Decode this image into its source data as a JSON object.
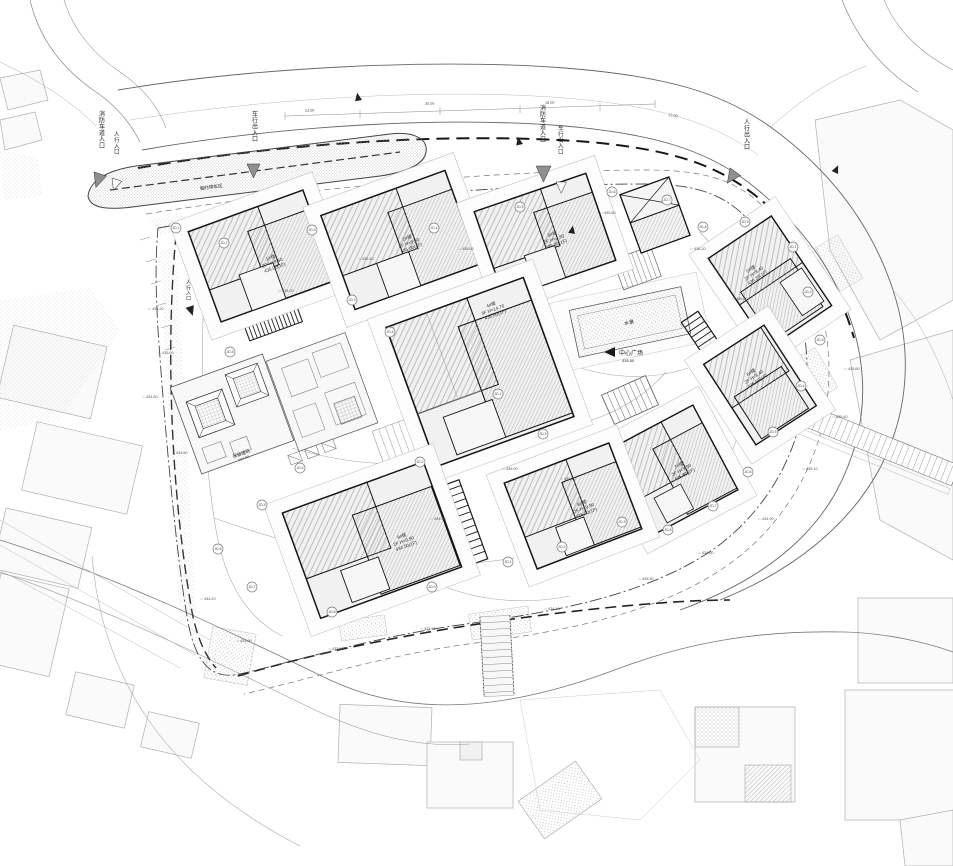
{
  "palette": {
    "paper": "#ffffff",
    "building_line": "#161616",
    "road_line": "#666666",
    "light_line": "#b0b0b0",
    "arrow_fill": "#8f8f8f",
    "boundary": "#333333"
  },
  "texts": {
    "plaza": "中心广场",
    "plaza_elev": "435.50",
    "pool": "水景",
    "island": "临时停车区",
    "preserved": "保留建筑",
    "preserved_elev": "434.80"
  },
  "buildings": [
    {
      "name": "1#楼",
      "l2": "2F H=9.50",
      "l3": "435.00(1F)"
    },
    {
      "name": "2#楼",
      "l2": "2F H=9.50",
      "l3": "435.00(1F)"
    },
    {
      "name": "3#楼",
      "l2": "2F H=9.50",
      "l3": "435.30(1F)"
    },
    {
      "name": "4#楼",
      "l2": "3F H=14.70",
      "l3": "435.00(1F)"
    },
    {
      "name": "5#楼",
      "l2": "2F H=8.40",
      "l3": "436.20(1F)"
    },
    {
      "name": "6#楼",
      "l2": "2F H=8.40",
      "l3": "436.50(1F)"
    },
    {
      "name": "7#楼",
      "l2": "2F H=9.90",
      "l3": "435.80(1F)"
    },
    {
      "name": "8#楼",
      "l2": "2F H=9.90",
      "l3": "435.00(1F)"
    },
    {
      "name": "9#楼",
      "l2": "2F H=9.90",
      "l3": "434.50(1F)"
    }
  ],
  "vertical_labels": [
    {
      "x": 99,
      "y": 116,
      "s": 6.0,
      "t": "消防车道入口"
    },
    {
      "x": 114,
      "y": 136,
      "s": 5.6,
      "t": "人行入口"
    },
    {
      "x": 252,
      "y": 116,
      "s": 6.0,
      "t": "车行出入口"
    },
    {
      "x": 540,
      "y": 110,
      "s": 6.0,
      "t": "消防车道入口"
    },
    {
      "x": 558,
      "y": 130,
      "s": 5.6,
      "t": "车行出入口"
    },
    {
      "x": 744,
      "y": 124,
      "s": 6.0,
      "t": "人行出入口"
    },
    {
      "x": 186,
      "y": 284,
      "s": 5.0,
      "t": "人行入口"
    }
  ],
  "annotations": [
    {
      "x": 176,
      "y": 228,
      "c": "JD-1"
    },
    {
      "x": 224,
      "y": 243,
      "c": "JD-2"
    },
    {
      "x": 312,
      "y": 230,
      "c": "JD-3"
    },
    {
      "x": 434,
      "y": 228,
      "c": "JD-4"
    },
    {
      "x": 520,
      "y": 207,
      "c": "JD-5"
    },
    {
      "x": 612,
      "y": 192,
      "c": "JD-6"
    },
    {
      "x": 667,
      "y": 200,
      "c": "JD-7"
    },
    {
      "x": 703,
      "y": 227,
      "c": "JD-8"
    },
    {
      "x": 745,
      "y": 222,
      "c": "JD-9"
    },
    {
      "x": 793,
      "y": 247,
      "c": "JD-1"
    },
    {
      "x": 808,
      "y": 292,
      "c": "JD-2"
    },
    {
      "x": 820,
      "y": 340,
      "c": "JD-3"
    },
    {
      "x": 801,
      "y": 386,
      "c": "JD-4"
    },
    {
      "x": 773,
      "y": 432,
      "c": "JD-5"
    },
    {
      "x": 748,
      "y": 472,
      "c": "JD-6"
    },
    {
      "x": 713,
      "y": 506,
      "c": "JD-7"
    },
    {
      "x": 668,
      "y": 530,
      "c": "JD-8"
    },
    {
      "x": 543,
      "y": 434,
      "c": "JD-9"
    },
    {
      "x": 498,
      "y": 394,
      "c": "JD-1"
    },
    {
      "x": 420,
      "y": 462,
      "c": "JD-2"
    },
    {
      "x": 352,
      "y": 300,
      "c": "JD-3"
    },
    {
      "x": 300,
      "y": 468,
      "c": "JD-4"
    },
    {
      "x": 262,
      "y": 505,
      "c": "JD-5"
    },
    {
      "x": 218,
      "y": 549,
      "c": "JD-6"
    },
    {
      "x": 252,
      "y": 587,
      "c": "JD-7"
    },
    {
      "x": 332,
      "y": 612,
      "c": "JD-8"
    },
    {
      "x": 432,
      "y": 587,
      "c": "JD-9"
    },
    {
      "x": 508,
      "y": 562,
      "c": "JD-1"
    },
    {
      "x": 562,
      "y": 547,
      "c": "JD-2"
    },
    {
      "x": 622,
      "y": 522,
      "c": "JD-3"
    },
    {
      "x": 390,
      "y": 332,
      "c": "JD-4"
    },
    {
      "x": 230,
      "y": 352,
      "c": "JD-5"
    }
  ],
  "spots": [
    {
      "x": 152,
      "y": 308,
      "v": "435.20"
    },
    {
      "x": 162,
      "y": 352,
      "v": "435.00"
    },
    {
      "x": 146,
      "y": 396,
      "v": "434.80"
    },
    {
      "x": 176,
      "y": 452,
      "v": "434.60"
    },
    {
      "x": 204,
      "y": 598,
      "v": "434.20"
    },
    {
      "x": 240,
      "y": 640,
      "v": "434.00"
    },
    {
      "x": 332,
      "y": 648,
      "v": "433.80"
    },
    {
      "x": 424,
      "y": 628,
      "v": "433.90"
    },
    {
      "x": 548,
      "y": 608,
      "v": "434.10"
    },
    {
      "x": 642,
      "y": 578,
      "v": "434.30"
    },
    {
      "x": 702,
      "y": 552,
      "v": "434.60"
    },
    {
      "x": 762,
      "y": 518,
      "v": "434.90"
    },
    {
      "x": 806,
      "y": 468,
      "v": "435.10"
    },
    {
      "x": 836,
      "y": 416,
      "v": "435.40"
    },
    {
      "x": 848,
      "y": 368,
      "v": "435.60"
    },
    {
      "x": 736,
      "y": 298,
      "v": "436.00"
    },
    {
      "x": 694,
      "y": 248,
      "v": "436.20"
    },
    {
      "x": 604,
      "y": 212,
      "v": "435.80"
    },
    {
      "x": 462,
      "y": 248,
      "v": "435.60"
    },
    {
      "x": 362,
      "y": 258,
      "v": "435.40"
    },
    {
      "x": 282,
      "y": 290,
      "v": "435.20"
    },
    {
      "x": 506,
      "y": 468,
      "v": "435.00"
    },
    {
      "x": 434,
      "y": 518,
      "v": "434.90"
    },
    {
      "x": 564,
      "y": 478,
      "v": "435.10"
    }
  ],
  "dims": [
    {
      "x": 305,
      "y": 112,
      "v": "24.00",
      "r": -3
    },
    {
      "x": 425,
      "y": 105,
      "v": "30.00",
      "r": -2
    },
    {
      "x": 545,
      "y": 104,
      "v": "18.00",
      "r": -1
    },
    {
      "x": 668,
      "y": 116,
      "v": "12.00",
      "r": 8
    }
  ]
}
